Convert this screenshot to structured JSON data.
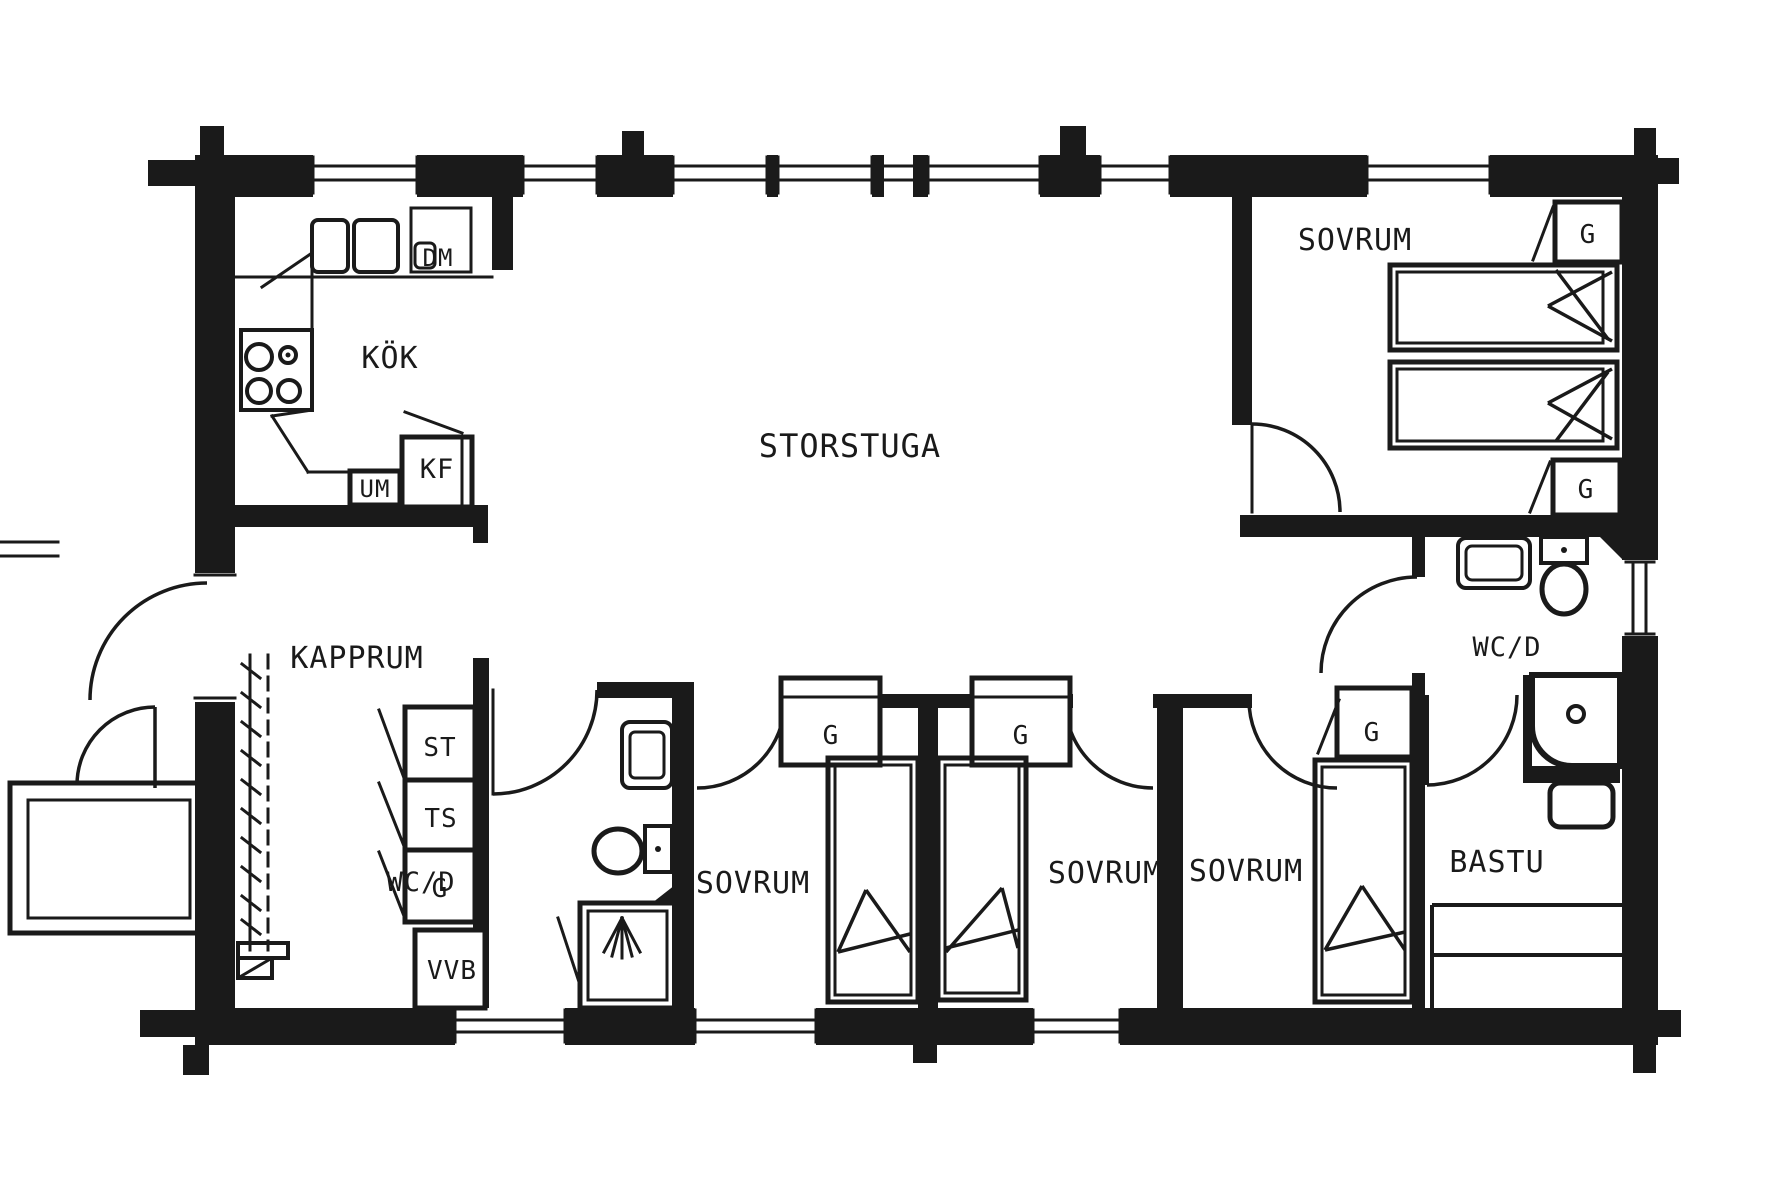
{
  "drawing": {
    "type": "floor-plan",
    "ink_color": "#1a1a1a",
    "paper_color": "#ffffff"
  },
  "labels": {
    "storstuga": "STORSTUGA",
    "kok": "KÖK",
    "kapprum": "KAPPRUM",
    "sovrum": "SOVRUM",
    "wcd": "WC/D",
    "bastu": "BASTU",
    "vvb": "VVB",
    "st": "ST",
    "ts": "TS",
    "g": "G",
    "kf": "KF",
    "um": "UM",
    "dm": "DM"
  }
}
